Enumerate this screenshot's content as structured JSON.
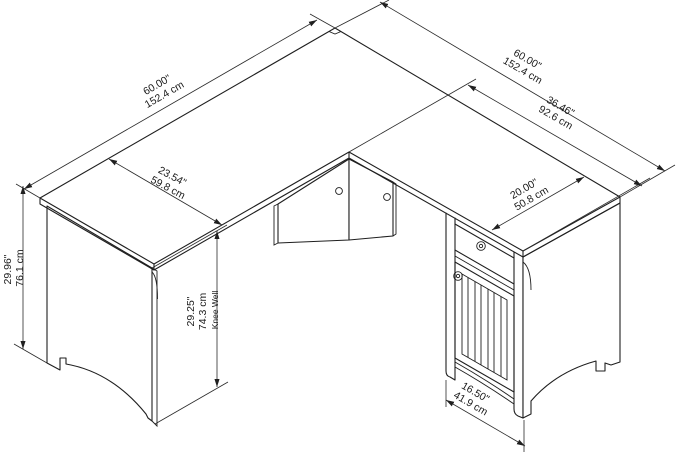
{
  "diagram": {
    "title": "L-shaped desk dimension diagram",
    "style": "isometric line drawing",
    "line_color": "#1f1f1f",
    "background_color": "#ffffff",
    "dimensions": {
      "left_back_width": {
        "in": "60.00\"",
        "cm": "152.4 cm"
      },
      "right_back_width": {
        "in": "60.00\"",
        "cm": "152.4 cm"
      },
      "right_front_length": {
        "in": "36.46\"",
        "cm": "92.6 cm"
      },
      "left_depth": {
        "in": "23.54\"",
        "cm": "59.8 cm"
      },
      "right_depth": {
        "in": "20.00\"",
        "cm": "50.8 cm"
      },
      "height": {
        "in": "29.96\"",
        "cm": "76.1 cm"
      },
      "knee_well": {
        "in": "29.25\"",
        "cm": "74.3 cm",
        "note": "Knee Well"
      },
      "cabinet_width": {
        "in": "16.50\"",
        "cm": "41.9 cm"
      }
    },
    "parts": {
      "desktop": "L-shaped desktop",
      "left_pedestal": "left side panel with arched base",
      "corner_rails": "corner support rails with cam holes",
      "cabinet": "storage cabinet with drawer and slatted door",
      "right_end_panel": "right end panel with arched base"
    }
  }
}
